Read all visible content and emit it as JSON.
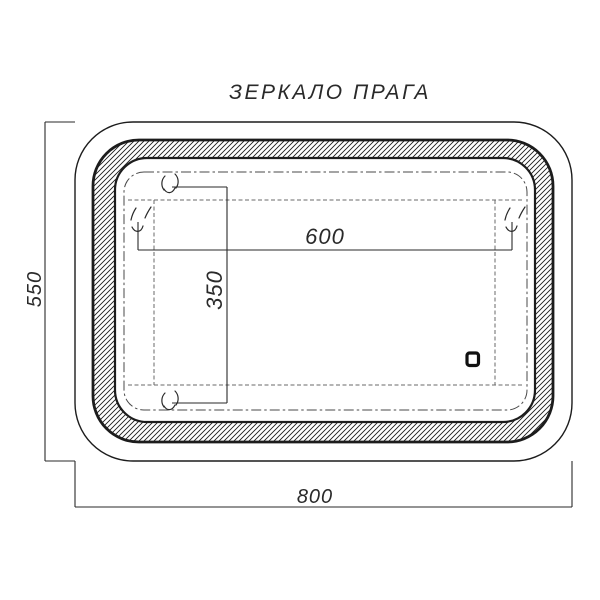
{
  "title": "ЗЕРКАЛО ПРАГА",
  "dimensions": {
    "overall_width_mm": "800",
    "overall_height_mm": "550",
    "led_zone_width_mm": "600",
    "led_zone_height_mm": "350"
  },
  "icons": {
    "sensor": "power-sensor-icon"
  },
  "colors": {
    "line": "#1c1c1c",
    "dim_line": "#2a2a2a",
    "dash_fine": "#6a6a6a",
    "dash_center": "#4a4a4a",
    "background": "#ffffff"
  }
}
